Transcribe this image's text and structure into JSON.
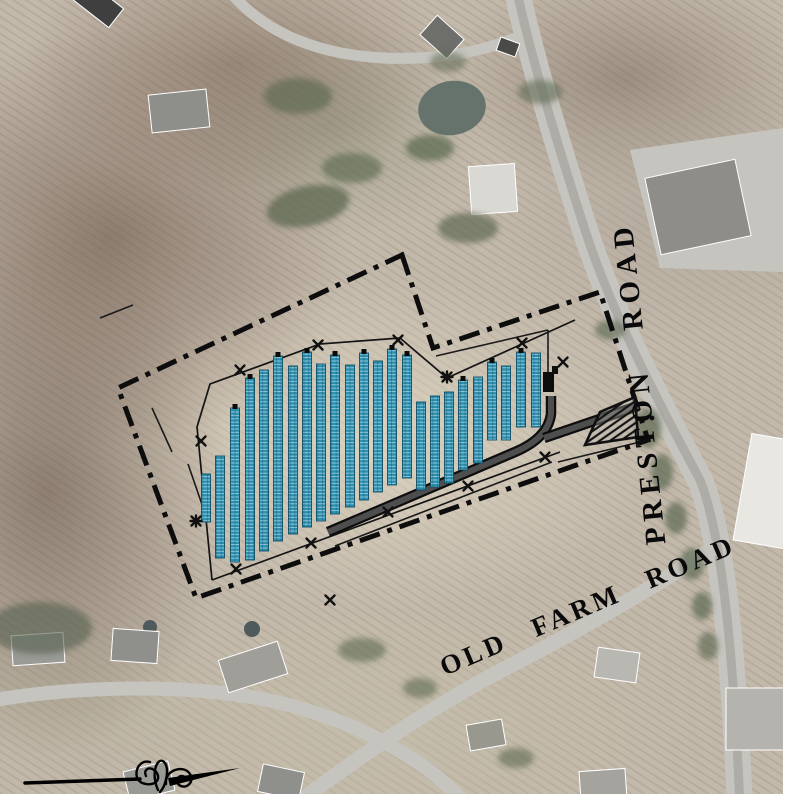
{
  "labels": {
    "preston": "PRESTON ROAD",
    "old_farm": "OLD FARM ROAD"
  },
  "colors": {
    "panel_fill": "#2b8fb0",
    "panel_grid_light": "#9fd8e4",
    "panel_edge": "#0f4e64",
    "linework": "#0d0d0d",
    "aerial_base": "#c3b9ab"
  },
  "site_plan": {
    "panel_width": 9,
    "panel_columns": [
      [
        206,
        474,
        522,
        0
      ],
      [
        220,
        456,
        558,
        0
      ],
      [
        235,
        408,
        562,
        1
      ],
      [
        250,
        378,
        560,
        1
      ],
      [
        264,
        370,
        551,
        0
      ],
      [
        278,
        356,
        541,
        1
      ],
      [
        293,
        366,
        534,
        0
      ],
      [
        307,
        352,
        527,
        1
      ],
      [
        321,
        364,
        521,
        0
      ],
      [
        335,
        355,
        514,
        1
      ],
      [
        350,
        365,
        507,
        0
      ],
      [
        364,
        353,
        500,
        1
      ],
      [
        378,
        361,
        492,
        0
      ],
      [
        392,
        349,
        485,
        1
      ],
      [
        407,
        355,
        478,
        1
      ],
      [
        421,
        402,
        490,
        0
      ],
      [
        435,
        396,
        487,
        0
      ],
      [
        449,
        392,
        483,
        0
      ],
      [
        463,
        380,
        470,
        1
      ],
      [
        478,
        377,
        463,
        0
      ],
      [
        492,
        362,
        440,
        1
      ],
      [
        506,
        366,
        440,
        0
      ],
      [
        521,
        352,
        427,
        1
      ],
      [
        536,
        353,
        427,
        0
      ]
    ],
    "boundary": "402,255 433,348 600,292 648,440 196,598 118,388",
    "fence_lines": [
      "212,580 197,427 210,384 320,344 400,338 447,378 575,320",
      "212,580 560,452"
    ],
    "thin_lines": [
      "100,318 133,305",
      "152,408 172,452",
      "188,464 207,519",
      "436,356 548,330",
      "548,330 548,392",
      "335,546 552,462",
      "558,462 648,440"
    ],
    "access_road_paths": [
      "M328 532 L515 452 Q548 438 551 414 L551 396",
      "M544 438 L638 406"
    ],
    "basin": "585,445 600,412 635,397 638,437",
    "equipment": [
      [
        543,
        372,
        11,
        20
      ],
      [
        552,
        366,
        6,
        8
      ]
    ],
    "markers": [
      [
        240,
        370,
        "x"
      ],
      [
        318,
        345,
        "x"
      ],
      [
        398,
        340,
        "x"
      ],
      [
        522,
        343,
        "x"
      ],
      [
        563,
        362,
        "x"
      ],
      [
        201,
        441,
        "x"
      ],
      [
        236,
        569,
        "x"
      ],
      [
        311,
        543,
        "x"
      ],
      [
        388,
        512,
        "x"
      ],
      [
        468,
        486,
        "x"
      ],
      [
        545,
        457,
        "x"
      ],
      [
        330,
        600,
        "x"
      ],
      [
        196,
        521,
        "star"
      ],
      [
        447,
        377,
        "star"
      ],
      [
        652,
        418,
        "dot"
      ]
    ]
  }
}
